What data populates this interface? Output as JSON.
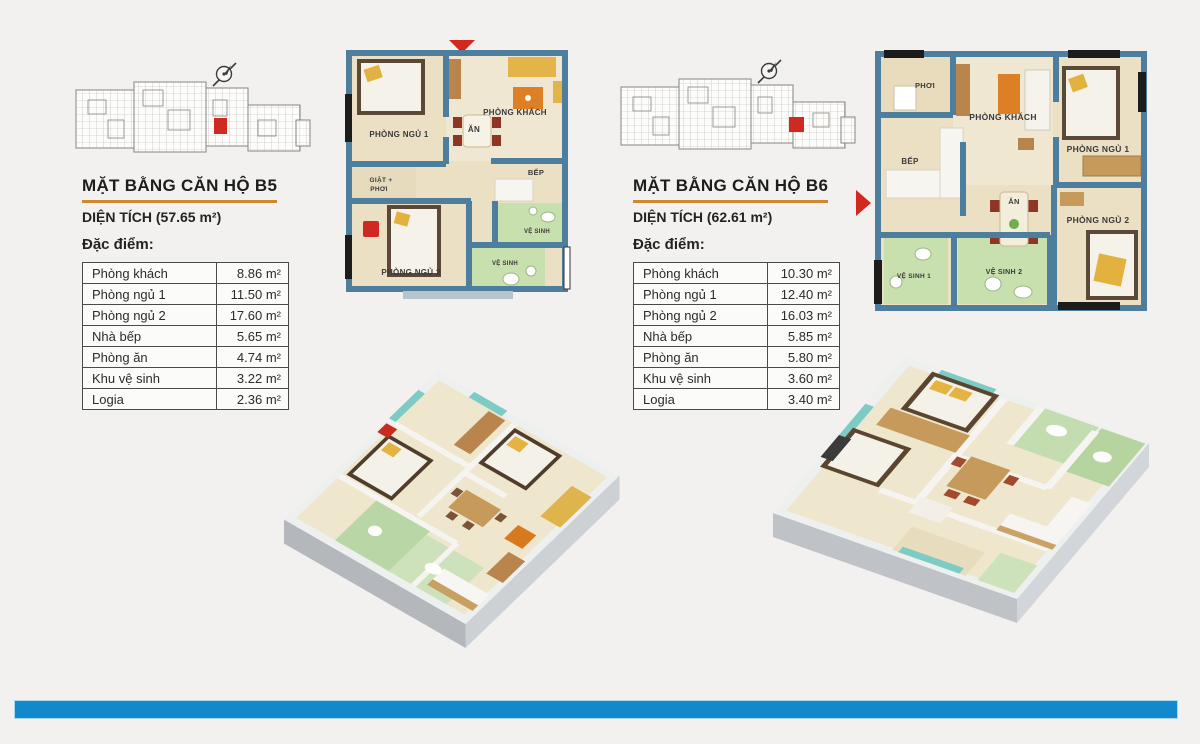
{
  "page": {
    "background_color": "#f2f1ef",
    "footer_bar_color": "#1289cb",
    "accent_underline_color": "#d0882e",
    "wall_color": "#4d7e9d",
    "bathroom_color": "#c8dfae",
    "highlight_unit_color": "#cf2a22"
  },
  "units": [
    {
      "code": "B5",
      "title": "MẶT BẰNG CĂN HỘ B5",
      "area_label": "DIỆN TÍCH (57.65 m²)",
      "features_label": "Đặc điểm:",
      "table": {
        "rows": [
          {
            "name": "Phòng khách",
            "value": "8.86 m²"
          },
          {
            "name": "Phòng ngủ 1",
            "value": "11.50 m²"
          },
          {
            "name": "Phòng ngủ 2",
            "value": "17.60 m²"
          },
          {
            "name": "Nhà bếp",
            "value": "5.65 m²"
          },
          {
            "name": "Phòng ăn",
            "value": "4.74 m²"
          },
          {
            "name": "Khu vệ sinh",
            "value": "3.22 m²"
          },
          {
            "name": "Logia",
            "value": "2.36 m²"
          }
        ]
      },
      "plan": {
        "bedroom1": "PHÒNG NGỦ 1",
        "living": "PHÒNG KHÁCH",
        "dining": "ĂN",
        "kitchen": "BẾP",
        "laundry_line1": "GIẶT +",
        "laundry_line2": "PHƠI",
        "bedroom2": "PHÒNG NGỦ 2",
        "wc1": "VỆ SINH",
        "wc2": "VỆ SINH"
      }
    },
    {
      "code": "B6",
      "title": "MẶT BẰNG CĂN HỘ B6",
      "area_label": "DIỆN TÍCH (62.61 m²)",
      "features_label": "Đặc điểm:",
      "table": {
        "rows": [
          {
            "name": "Phòng khách",
            "value": "10.30 m²"
          },
          {
            "name": "Phòng ngủ 1",
            "value": "12.40 m²"
          },
          {
            "name": "Phòng ngủ 2",
            "value": "16.03 m²"
          },
          {
            "name": "Nhà bếp",
            "value": "5.85 m²"
          },
          {
            "name": "Phòng ăn",
            "value": "5.80 m²"
          },
          {
            "name": "Khu vệ sinh",
            "value": "3.60 m²"
          },
          {
            "name": "Logia",
            "value": "3.40 m²"
          }
        ]
      },
      "plan": {
        "drying": "PHƠI",
        "living": "PHÒNG KHÁCH",
        "bedroom1": "PHÒNG NGỦ 1",
        "kitchen": "BẾP",
        "dining": "ĂN",
        "bedroom2": "PHÒNG NGỦ 2",
        "wc1": "VỆ SINH 1",
        "wc2": "VỆ SINH 2"
      }
    }
  ]
}
